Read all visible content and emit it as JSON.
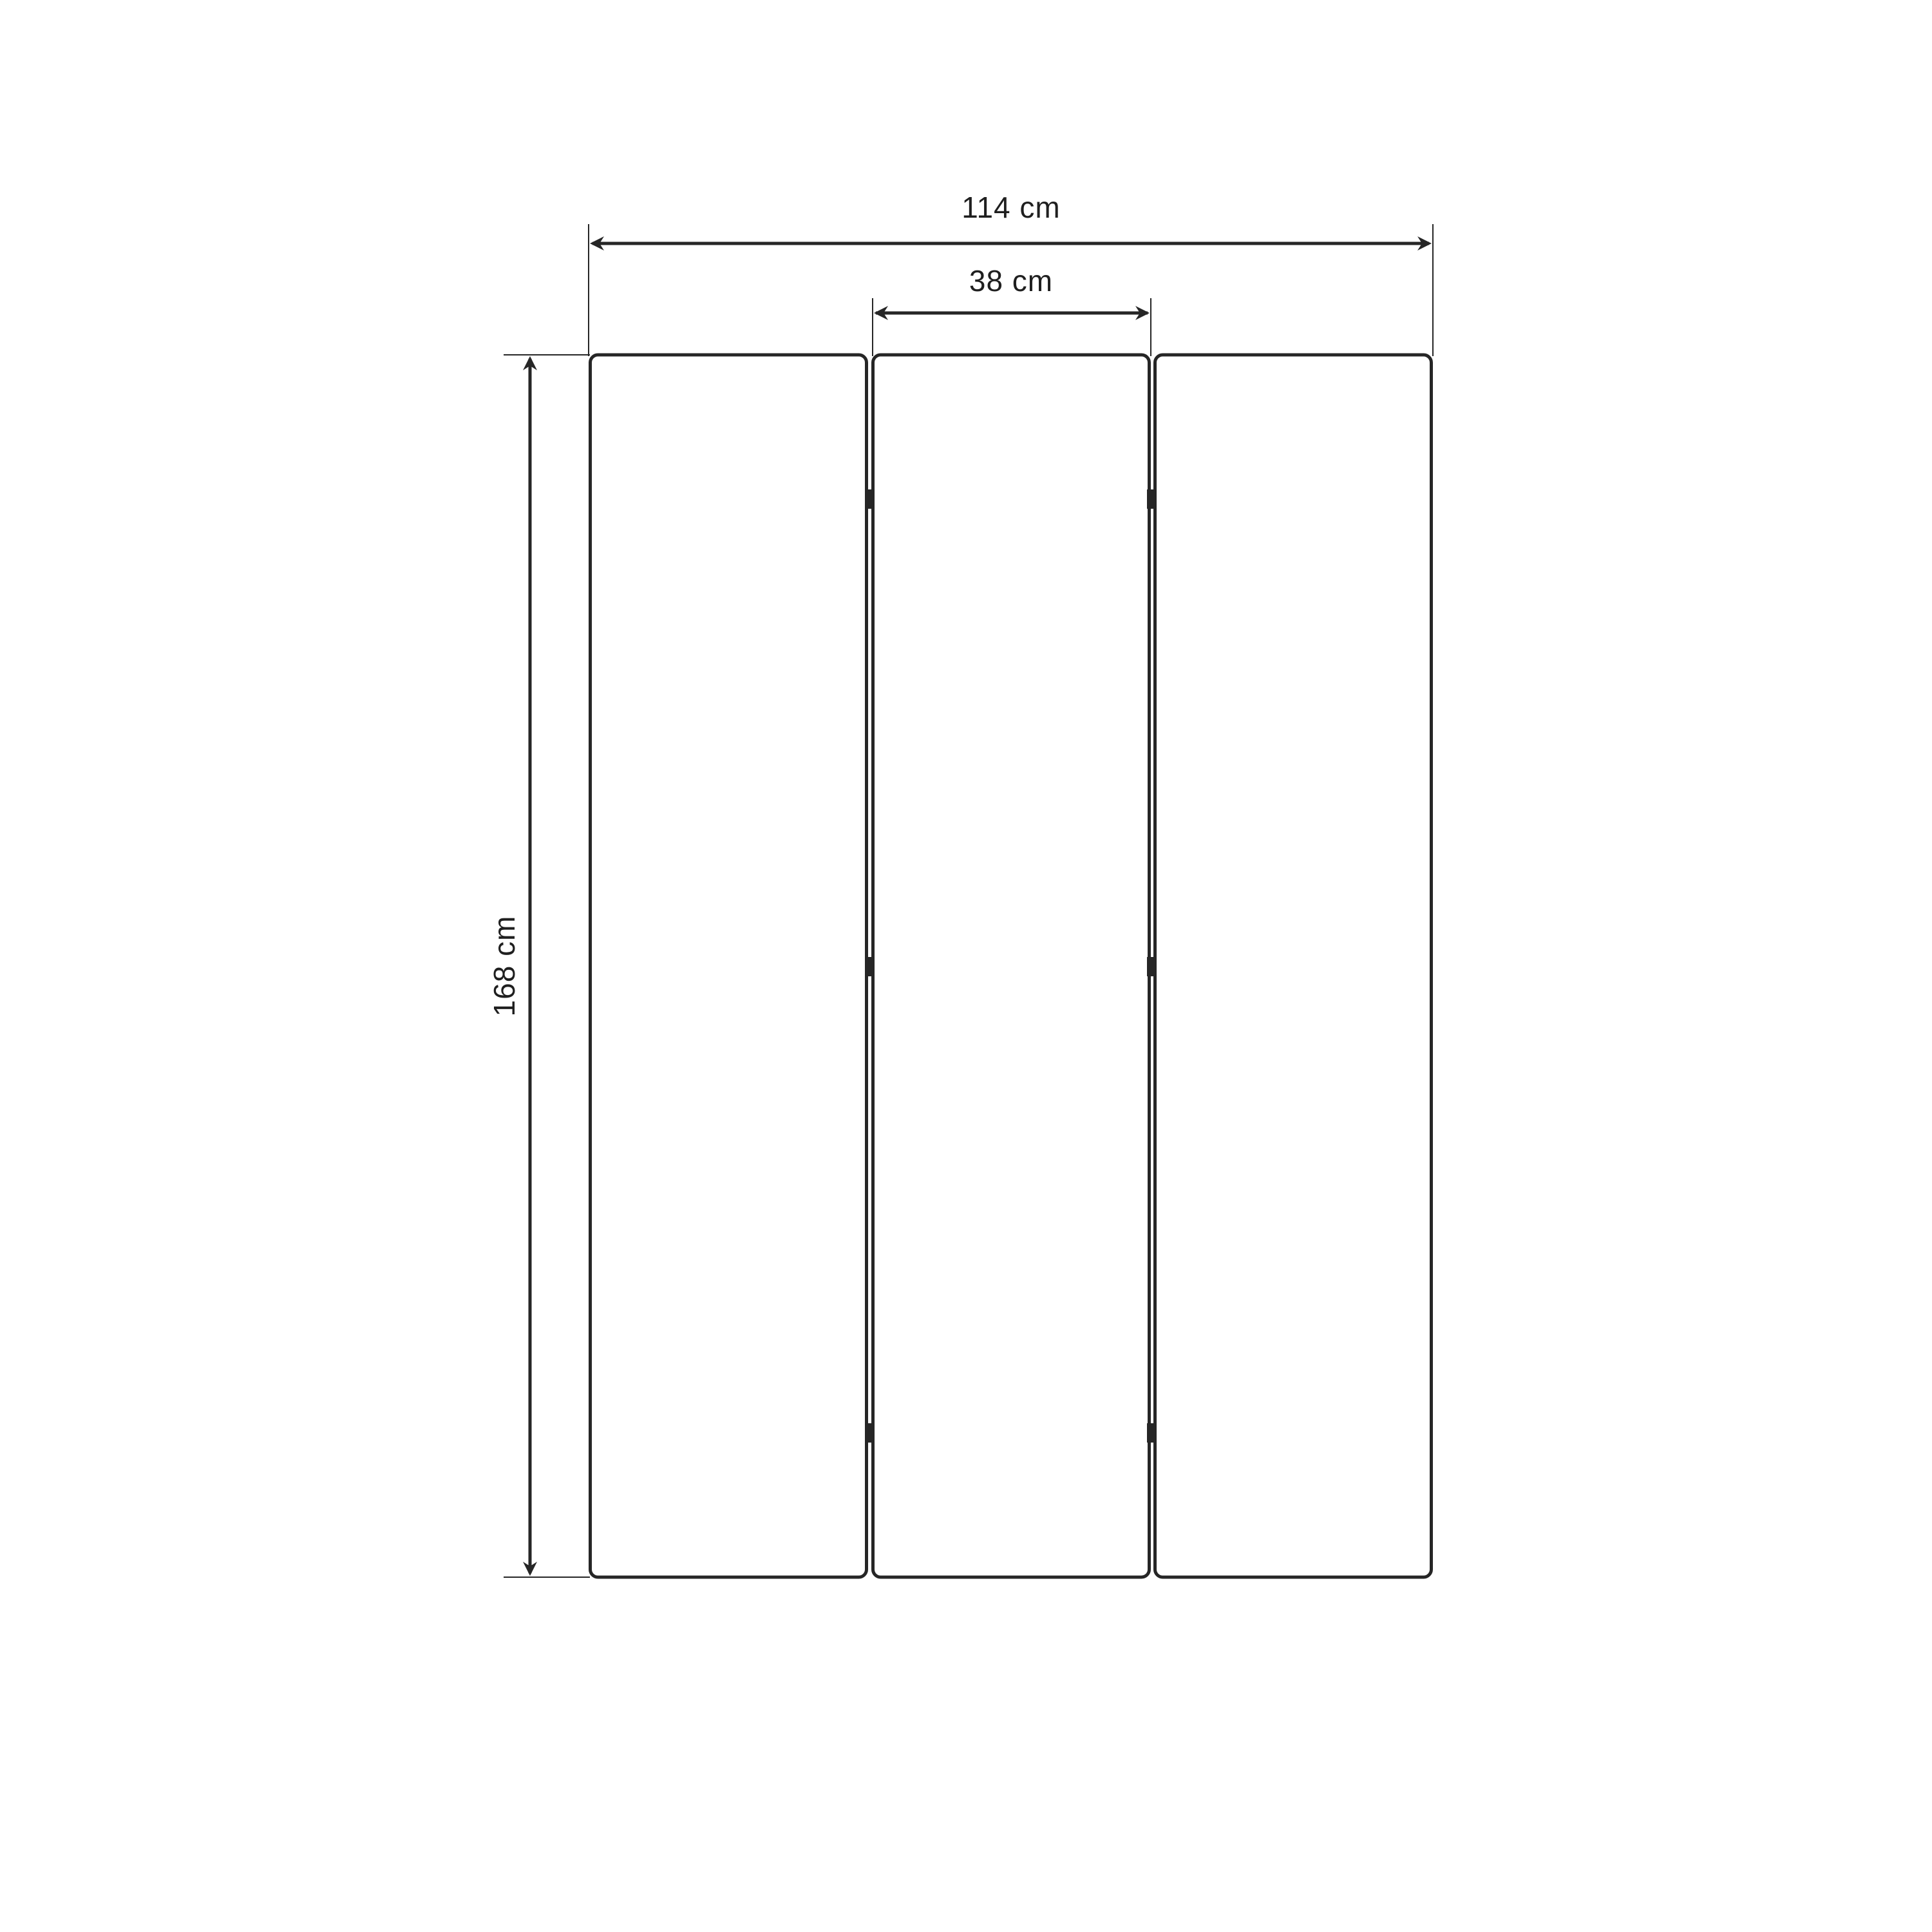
{
  "diagram": {
    "type": "technical-dimension-drawing",
    "background_color": "#ffffff",
    "line_color": "#262626",
    "text_color": "#1f1f1f",
    "labels": {
      "total_width": "114 cm",
      "panel_width": "38 cm",
      "height": "168 cm"
    },
    "panel_count": 3,
    "hinge_count": 6
  }
}
